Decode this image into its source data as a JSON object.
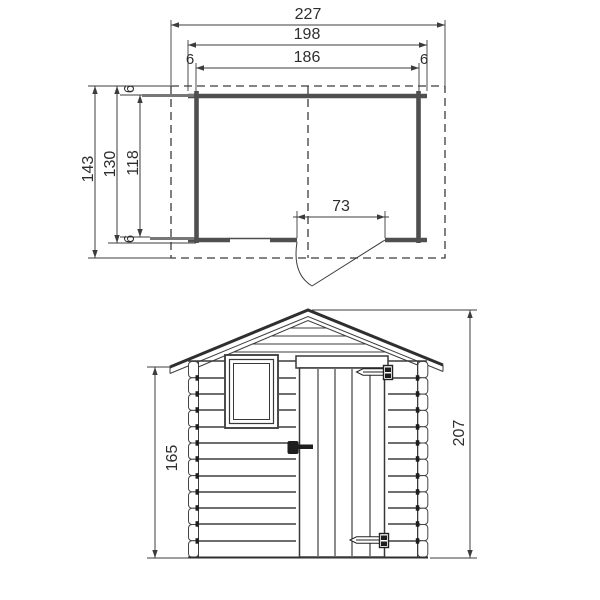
{
  "plan": {
    "dim_total_width": "227",
    "dim_outer_width": "198",
    "dim_inner_width": "186",
    "dim_corner_left": "6",
    "dim_corner_right": "6",
    "dim_total_depth": "143",
    "dim_outer_depth": "130",
    "dim_inner_depth": "118",
    "dim_corner_top": "6",
    "dim_corner_bottom": "6",
    "dim_door_width": "73"
  },
  "elevation": {
    "dim_wall_height": "165",
    "dim_total_height": "207"
  },
  "colors": {
    "background": "#ffffff",
    "line": "#3c3c3c",
    "wall": "#4f4f4f",
    "roof": "#2f2f2f",
    "text": "#2e2e2e"
  }
}
